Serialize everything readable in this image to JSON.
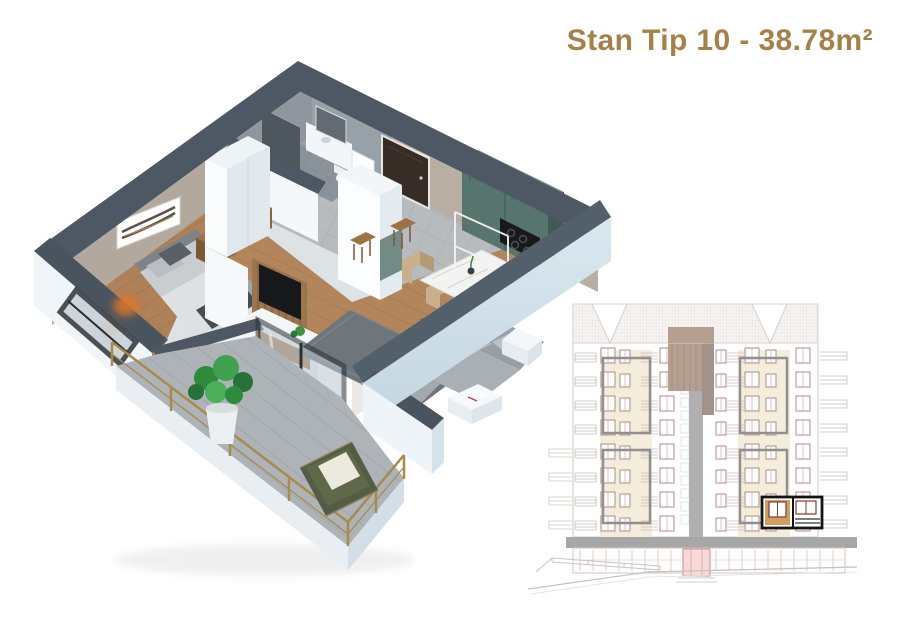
{
  "header": {
    "title": "Stan Tip 10 - 38.78m²"
  },
  "palette": {
    "accent_gold": "#a5814a",
    "wall_top": "#4d5864",
    "wall_face_light": "#f0f5f9",
    "wall_face_shade": "#cfdde9",
    "interior_wall_beige": "#b7aca2",
    "kitchen_green": "#57756d",
    "wood_floor": "#b2855c",
    "tile_gray": "#b7bbbe",
    "balcony_rail_brass": "#a8894e",
    "elevation_line_pink": "#b08a8a",
    "highlight_outline": "#141414"
  },
  "floor_plan": {
    "rooms": [
      "bedroom",
      "bathroom",
      "hallway",
      "kitchen",
      "dining-area",
      "living-room",
      "balcony"
    ]
  },
  "elevation": {
    "floor_rows": 8,
    "has_highlighted_unit": true
  }
}
